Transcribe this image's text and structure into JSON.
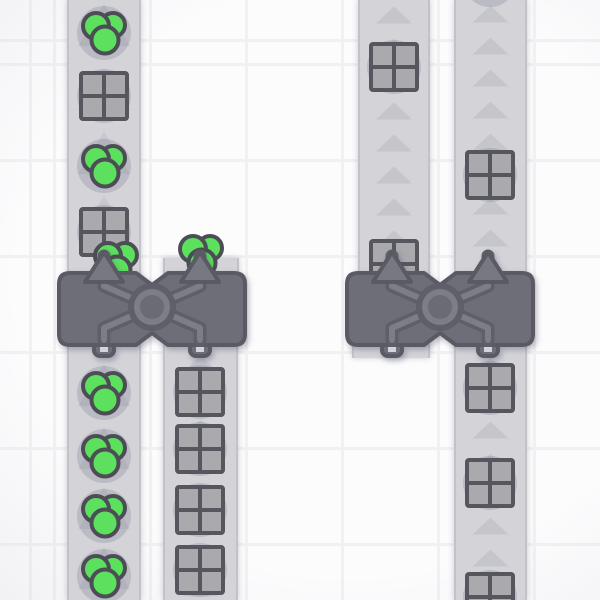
{
  "scene": {
    "viewport": {
      "width": 600,
      "height": 600
    },
    "grid": {
      "tile_size": 96,
      "line_color": "#f1f1f4",
      "bg_color": "#fcfcfd",
      "vignette_color": "rgba(203,203,214,0.55)",
      "line_offset_x": 53,
      "line_offset_y": 63
    },
    "colors": {
      "belt": "#d3d3d8",
      "belt_edge": "#c2c2c9",
      "arrow_small": "#c5c5cc",
      "arrow_large": "#c7c7ce",
      "building_body": "#6e6e78",
      "building_border": "#5a5a64",
      "building_arm_dark": "#5f5f69",
      "building_arm_light": "#7d7d87",
      "building_ring_core": "#6b6b75",
      "building_arrow_fill": "#787882",
      "pipe_hole": "#d3d3d8",
      "shape_green": "#5ce05e",
      "shape_outline": "#4d4d56",
      "crate_fill": "#a9a9ae",
      "crate_border": "#56565f",
      "item_shadow": "rgba(124,124,148,0.28)"
    },
    "belts": [
      {
        "id": "belt-top-left",
        "x": 67,
        "y": 0,
        "width": 74,
        "height": 280,
        "direction": "up",
        "arrow_style": "large",
        "arrows_y": [
          25,
          89,
          153,
          217
        ]
      },
      {
        "id": "belt-bottom-left",
        "x": 67,
        "y": 340,
        "width": 74,
        "height": 260,
        "direction": "up",
        "arrow_style": "large",
        "arrows_y": [
          385,
          448,
          508,
          568
        ]
      },
      {
        "id": "belt-bottom-mid",
        "x": 163,
        "y": 340,
        "width": 75,
        "height": 260,
        "direction": "up",
        "arrow_style": "small",
        "arrows_y": [
          364,
          396,
          428,
          460,
          492,
          524,
          556,
          588
        ]
      },
      {
        "id": "belt-top-right-1",
        "x": 358,
        "y": 0,
        "width": 72,
        "height": 280,
        "direction": "up",
        "arrow_style": "small",
        "arrows_y": [
          15,
          47,
          79,
          111,
          143,
          175,
          207,
          239
        ]
      },
      {
        "id": "belt-top-right-2",
        "x": 454,
        "y": 0,
        "width": 73,
        "height": 280,
        "direction": "up",
        "arrow_style": "small",
        "arrows_y": [
          14,
          46,
          78,
          110,
          142,
          174,
          206,
          238,
          270
        ]
      },
      {
        "id": "belt-bottom-right",
        "x": 454,
        "y": 340,
        "width": 73,
        "height": 260,
        "direction": "up",
        "arrow_style": "small",
        "arrows_y": [
          366,
          398,
          430,
          462,
          494,
          526,
          558,
          590
        ]
      }
    ],
    "belt_stubs": [
      {
        "id": "stub-left-building-output",
        "x": 163,
        "y": 258,
        "width": 76,
        "height": 18
      },
      {
        "id": "stub-right-building-input",
        "x": 352,
        "y": 344,
        "width": 78,
        "height": 14
      }
    ],
    "buildings": [
      {
        "id": "balancer-left",
        "type": "balancer-2x1",
        "x": 56,
        "y": 244,
        "direction": "up"
      },
      {
        "id": "balancer-right",
        "type": "balancer-2x1",
        "x": 344,
        "y": 244,
        "direction": "up"
      }
    ],
    "items": [
      {
        "shape": "circles",
        "x": 104,
        "y": 33,
        "shadow": true
      },
      {
        "shape": "squares",
        "x": 104,
        "y": 96,
        "shadow": true
      },
      {
        "shape": "circles",
        "x": 104,
        "y": 166,
        "shadow": true
      },
      {
        "shape": "squares",
        "x": 104,
        "y": 232,
        "shadow": true
      },
      {
        "shape": "circles",
        "x": 116,
        "y": 263,
        "shadow": false
      },
      {
        "shape": "circles",
        "x": 201,
        "y": 256,
        "shadow": false
      },
      {
        "shape": "squares",
        "x": 394,
        "y": 264,
        "shadow": false
      },
      {
        "shape": "circles",
        "x": 104,
        "y": 393,
        "shadow": true
      },
      {
        "shape": "circles",
        "x": 104,
        "y": 456,
        "shadow": true
      },
      {
        "shape": "circles",
        "x": 104,
        "y": 516,
        "shadow": true
      },
      {
        "shape": "circles",
        "x": 104,
        "y": 576,
        "shadow": true
      },
      {
        "shape": "squares",
        "x": 200,
        "y": 392,
        "shadow": true
      },
      {
        "shape": "squares",
        "x": 200,
        "y": 449,
        "shadow": true
      },
      {
        "shape": "squares",
        "x": 200,
        "y": 510,
        "shadow": true
      },
      {
        "shape": "squares",
        "x": 200,
        "y": 570,
        "shadow": true
      },
      {
        "shape": "squares",
        "x": 394,
        "y": 67,
        "shadow": true
      },
      {
        "shape": "squares",
        "x": 490,
        "y": 175,
        "shadow": true
      },
      {
        "shape": "shadow",
        "x": 490,
        "y": -20,
        "shadow": true
      },
      {
        "shape": "squares",
        "x": 490,
        "y": 388,
        "shadow": true
      },
      {
        "shape": "squares",
        "x": 490,
        "y": 483,
        "shadow": true
      },
      {
        "shape": "squares",
        "x": 490,
        "y": 597,
        "shadow": true
      }
    ]
  }
}
